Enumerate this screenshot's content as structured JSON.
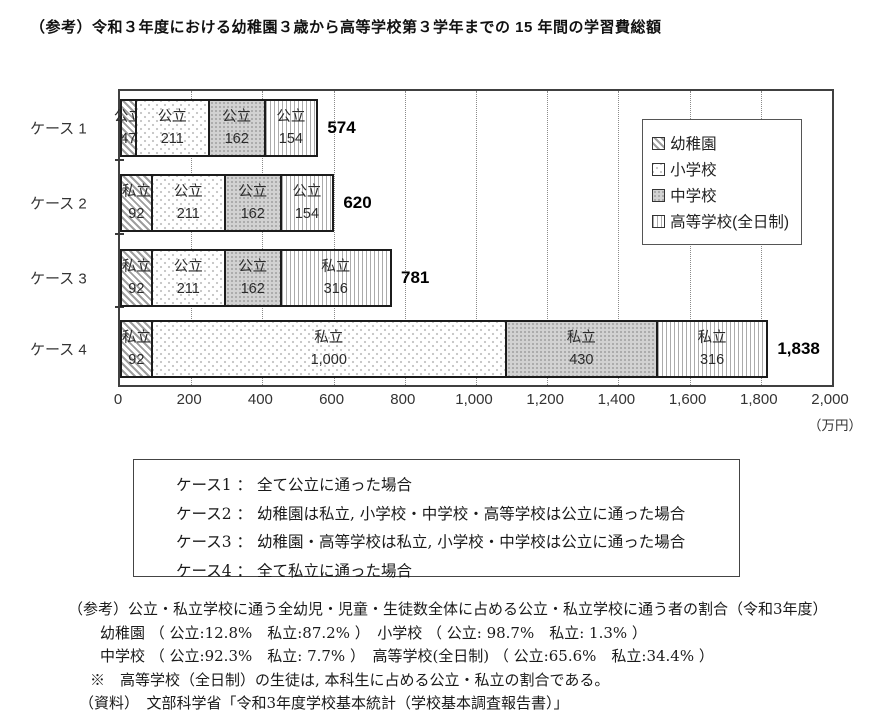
{
  "title": "（参考）令和３年度における幼稚園３歳から高等学校第３学年までの 15 年間の学習費総額",
  "colors": {
    "bar_border": "#1c1c1c",
    "hatch_gray": "#9e9e9e",
    "junior_high_gray": "#d2d2d2",
    "grid_gray": "#8a8a8a",
    "text": "#1a1a1a"
  },
  "chart_data": {
    "type": "bar",
    "orientation": "horizontal",
    "stacked": true,
    "title": "令和3年度における幼稚園3歳から高等学校第3学年までの15年間の学習費総額",
    "xlabel": "学習費総額",
    "unit_label": "（万円）",
    "xlim": [
      0,
      2000
    ],
    "x_ticks": [
      "0",
      "200",
      "400",
      "600",
      "800",
      "1,000",
      "1,200",
      "1,400",
      "1,600",
      "1,800",
      "2,000"
    ],
    "grid": "vertical dotted lines every 200",
    "legend_position": "inside top-right",
    "legend": [
      "幼稚園",
      "小学校",
      "中学校",
      "高等学校(全日制)"
    ],
    "categories": [
      "ケース 1",
      "ケース 2",
      "ケース 3",
      "ケース 4"
    ],
    "bars": [
      {
        "category": "ケース 1",
        "total_label": "574",
        "segments": [
          {
            "school": "幼稚園",
            "sector": "公立",
            "value": 47,
            "label": "47"
          },
          {
            "school": "小学校",
            "sector": "公立",
            "value": 211,
            "label": "211"
          },
          {
            "school": "中学校",
            "sector": "公立",
            "value": 162,
            "label": "162"
          },
          {
            "school": "高等学校(全日制)",
            "sector": "公立",
            "value": 154,
            "label": "154"
          }
        ]
      },
      {
        "category": "ケース 2",
        "total_label": "620",
        "segments": [
          {
            "school": "幼稚園",
            "sector": "私立",
            "value": 92,
            "label": "92"
          },
          {
            "school": "小学校",
            "sector": "公立",
            "value": 211,
            "label": "211"
          },
          {
            "school": "中学校",
            "sector": "公立",
            "value": 162,
            "label": "162"
          },
          {
            "school": "高等学校(全日制)",
            "sector": "公立",
            "value": 154,
            "label": "154"
          }
        ]
      },
      {
        "category": "ケース 3",
        "total_label": "781",
        "segments": [
          {
            "school": "幼稚園",
            "sector": "私立",
            "value": 92,
            "label": "92"
          },
          {
            "school": "小学校",
            "sector": "公立",
            "value": 211,
            "label": "211"
          },
          {
            "school": "中学校",
            "sector": "公立",
            "value": 162,
            "label": "162"
          },
          {
            "school": "高等学校(全日制)",
            "sector": "私立",
            "value": 316,
            "label": "316"
          }
        ]
      },
      {
        "category": "ケース 4",
        "total_label": "1,838",
        "segments": [
          {
            "school": "幼稚園",
            "sector": "私立",
            "value": 92,
            "label": "92"
          },
          {
            "school": "小学校",
            "sector": "私立",
            "value": 1000,
            "label": "1,000"
          },
          {
            "school": "中学校",
            "sector": "私立",
            "value": 430,
            "label": "430"
          },
          {
            "school": "高等学校(全日制)",
            "sector": "私立",
            "value": 316,
            "label": "316"
          }
        ]
      }
    ]
  },
  "case_box": {
    "lines": [
      "ケース1 ： 全て公立に通った場合",
      "ケース2 ： 幼稚園は私立, 小学校・中学校・高等学校は公立に通った場合",
      "ケース3 ： 幼稚園・高等学校は私立, 小学校・中学校は公立に通った場合",
      "ケース4 ： 全て私立に通った場合"
    ]
  },
  "reference_note": {
    "lines": [
      "（参考）公立・私立学校に通う全幼児・児童・生徒数全体に占める公立・私立学校に通う者の割合（令和3年度）",
      "幼稚園 （ 公立:12.8%　私立:87.2% ）　小学校 （ 公立: 98.7%　私立: 1.3% ）",
      "中学校 （ 公立:92.3%　私立: 7.7% ）　高等学校(全日制) （ 公立:65.6%　私立:34.4% ）",
      "※　高等学校（全日制）の生徒は, 本科生に占める公立・私立の割合である。",
      "（資料）　文部科学省「令和3年度学校基本統計（学校基本調査報告書）」"
    ]
  }
}
